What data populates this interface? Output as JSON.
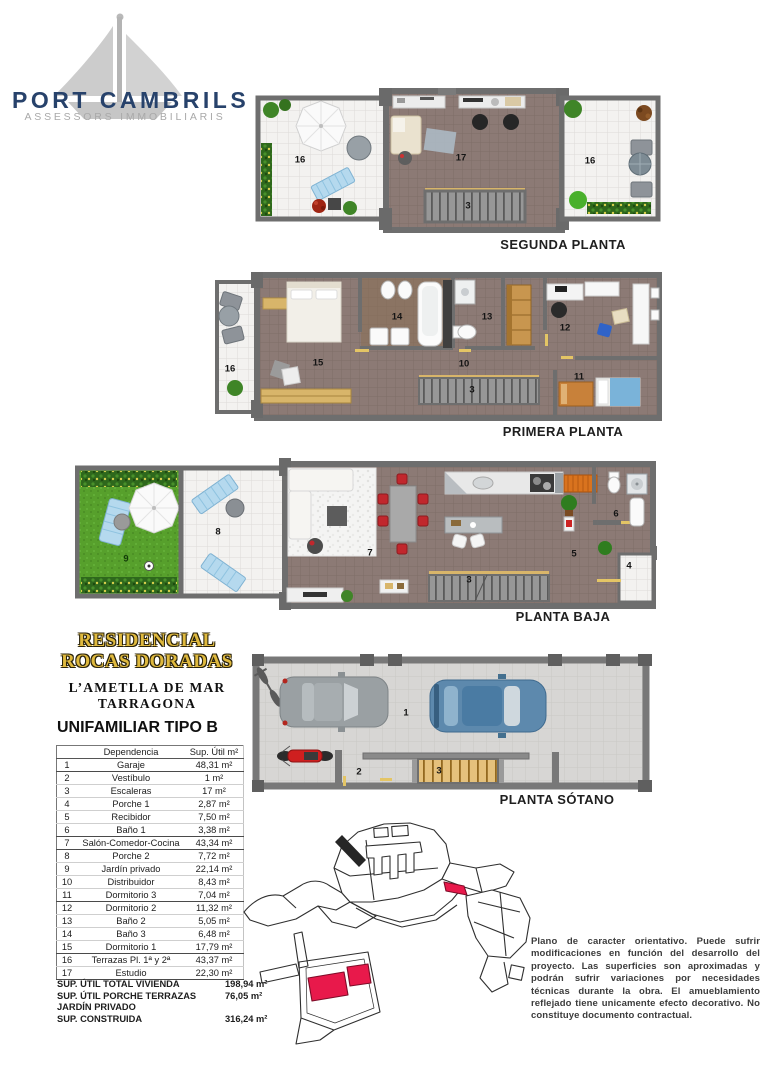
{
  "logo": {
    "title": "PORT CAMBRILS",
    "subtitle": "ASSESSORS IMMOBILIARIS"
  },
  "development": {
    "name_line1": "RESIDENCIAL",
    "name_line2": "ROCAS DORADAS",
    "location_line1": "L’AMETLLA DE MAR",
    "location_line2": "TARRAGONA",
    "unit_type": "UNIFAMILIAR TIPO B"
  },
  "plans": {
    "segunda": {
      "title": "SEGUNDA PLANTA",
      "labels": [
        "16",
        "17",
        "3",
        "16"
      ]
    },
    "primera": {
      "title": "PRIMERA PLANTA",
      "labels": [
        "16",
        "15",
        "14",
        "13",
        "10",
        "3",
        "12",
        "11"
      ]
    },
    "baja": {
      "title": "PLANTA BAJA",
      "labels": [
        "9",
        "8",
        "7",
        "3",
        "5",
        "6",
        "4"
      ]
    },
    "sotano": {
      "title": "PLANTA SÓTANO",
      "labels": [
        "1",
        "2",
        "3"
      ]
    }
  },
  "table": {
    "header_name": "Dependencia",
    "header_area": "Sup. Útil m²",
    "rows": [
      {
        "num": "1",
        "name": "Garaje",
        "area": "48,31 m²"
      },
      {
        "num": "2",
        "name": "Vestíbulo",
        "area": "1 m²"
      },
      {
        "num": "3",
        "name": "Escaleras",
        "area": "17 m²"
      },
      {
        "num": "4",
        "name": "Porche 1",
        "area": "2,87 m²"
      },
      {
        "num": "5",
        "name": "Recibidor",
        "area": "7,50 m²"
      },
      {
        "num": "6",
        "name": "Baño 1",
        "area": "3,38 m²"
      },
      {
        "num": "7",
        "name": "Salón-Comedor-Cocina",
        "area": "43,34 m²"
      },
      {
        "num": "8",
        "name": "Porche 2",
        "area": "7,72 m²"
      },
      {
        "num": "9",
        "name": "Jardín privado",
        "area": "22,14 m²"
      },
      {
        "num": "10",
        "name": "Distribuidor",
        "area": "8,43 m²"
      },
      {
        "num": "11",
        "name": "Dormitorio 3",
        "area": "7,04 m²"
      },
      {
        "num": "12",
        "name": "Dormitorio 2",
        "area": "11,32 m²"
      },
      {
        "num": "13",
        "name": "Baño 2",
        "area": "5,05 m²"
      },
      {
        "num": "14",
        "name": "Baño 3",
        "area": "6,48 m²"
      },
      {
        "num": "15",
        "name": "Dormitorio 1",
        "area": "17,79 m²"
      },
      {
        "num": "16",
        "name": "Terrazas Pl. 1ª y 2ª",
        "area": "43,37 m²"
      },
      {
        "num": "17",
        "name": "Estudio",
        "area": "22,30 m²"
      }
    ]
  },
  "summary": [
    {
      "label": "SUP. ÚTIL TOTAL VIVIENDA",
      "value": "198,94 m²"
    },
    {
      "label": "SUP. ÚTIL PORCHE TERRAZAS JARDÍN PRIVADO",
      "value": "76,05 m²"
    },
    {
      "label": "SUP. CONSTRUIDA",
      "value": "316,24 m²"
    }
  ],
  "disclaimer": "Plano de caracter orientativo. Puede sufrir modificaciones en función del desarrollo del proyecto. Las superficies son aproximadas y podrán sufrir variaciones por necesidades técnicas durante la obra. El amueblamiento reflejado tiene unicamente efecto decorativo. No constituye documento contractual.",
  "icons": {
    "sailboat-icon": "gray sailboat brand mark",
    "umbrella-icon": "white parasol, plan view",
    "car-icon": "car, plan view",
    "motorcycle-icon": "motorcycle, plan view",
    "bicycle-icon": "bicycle, plan view",
    "site-map": "urbanization plan with highlighted plot"
  },
  "colors": {
    "brand_navy": "#27426b",
    "brand_gray": "#a9a9a9",
    "title_gold": "#dfb93e",
    "floor": "#8c7a75",
    "terrace_tile": "#f3f2f0",
    "grass": "#57a02c",
    "wall": "#6e6e6e",
    "highlight_red": "#e8194b",
    "accent_wood": "#d8b56a"
  }
}
